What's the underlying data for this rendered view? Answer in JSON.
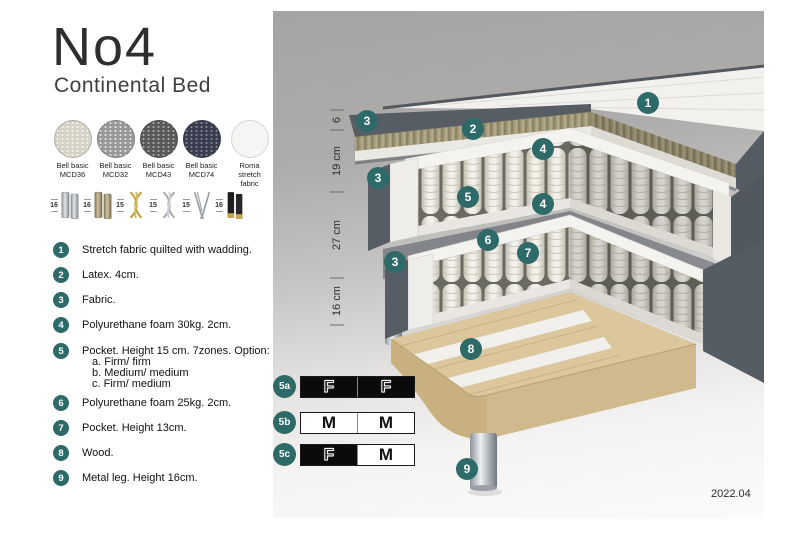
{
  "header": {
    "title": "No4",
    "subtitle": "Continental Bed"
  },
  "fabrics": [
    {
      "name": "Bell basic",
      "code": "MCD36",
      "color": "#d8d4c8"
    },
    {
      "name": "Bell basic",
      "code": "MCD32",
      "color": "#9a9a98"
    },
    {
      "name": "Bell basic",
      "code": "MCD43",
      "color": "#5a5a58"
    },
    {
      "name": "Bell basic",
      "code": "MCD74",
      "color": "#3a3d52"
    },
    {
      "name": "Roma",
      "code": "stretch fabric",
      "color": "#f5f5f4"
    }
  ],
  "legs": [
    {
      "height": "16",
      "style": "cylinder-silver"
    },
    {
      "height": "16",
      "style": "cylinder-bronze"
    },
    {
      "height": "15",
      "style": "twist-gold"
    },
    {
      "height": "15",
      "style": "twist-silver"
    },
    {
      "height": "15",
      "style": "hairpin-silver"
    },
    {
      "height": "16",
      "style": "cylinder-black-gold"
    }
  ],
  "parts": [
    {
      "num": "1",
      "text": "Stretch fabric quilted with wadding."
    },
    {
      "num": "2",
      "text": "Latex. 4cm."
    },
    {
      "num": "3",
      "text": "Fabric."
    },
    {
      "num": "4",
      "text": "Polyurethane foam 30kg. 2cm."
    },
    {
      "num": "5",
      "text": "Pocket. Height 15 cm. 7zones. Option:",
      "options": [
        "a. Firm/ firm",
        "b. Medium/ medium",
        "c. Firm/ medium"
      ]
    },
    {
      "num": "6",
      "text": "Polyurethane foam 25kg. 2cm."
    },
    {
      "num": "7",
      "text": "Pocket. Height 13cm."
    },
    {
      "num": "8",
      "text": "Wood."
    },
    {
      "num": "9",
      "text": "Metal leg. Height 16cm."
    }
  ],
  "diagram": {
    "badges": [
      "1",
      "2",
      "3",
      "3",
      "3",
      "4",
      "4",
      "5",
      "6",
      "7",
      "8",
      "9"
    ],
    "dimensions": [
      "6",
      "19 cm",
      "27 cm",
      "16 cm"
    ],
    "version": "2022.04"
  },
  "firmness": [
    {
      "label": "5a",
      "cells": [
        {
          "text": "F",
          "fill": "black"
        },
        {
          "text": "F",
          "fill": "black"
        }
      ]
    },
    {
      "label": "5b",
      "cells": [
        {
          "text": "M",
          "fill": "white"
        },
        {
          "text": "M",
          "fill": "white"
        }
      ]
    },
    {
      "label": "5c",
      "cells": [
        {
          "text": "F",
          "fill": "black"
        },
        {
          "text": "M",
          "fill": "white"
        }
      ]
    }
  ],
  "colors": {
    "badge_teal": "#2d6a68",
    "bed_fabric": "#565c64",
    "latex": "#a59c7c",
    "wood": "#dcc69c",
    "panel_grey": "#a5a4a2"
  }
}
